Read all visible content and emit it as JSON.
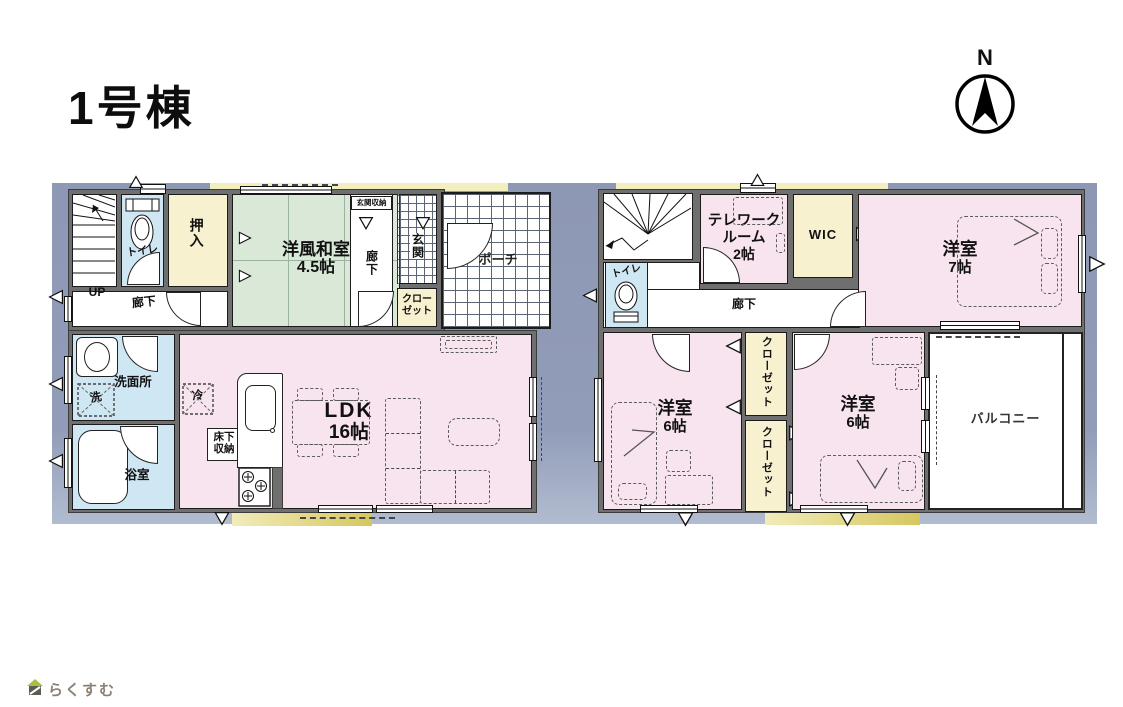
{
  "page": {
    "title": "1号棟"
  },
  "compass": {
    "label": "N"
  },
  "footer_logo": {
    "text": "らくすむ"
  },
  "colors": {
    "band": "#8d98b4",
    "wall": "#6f6f6f",
    "room_pink": "#f8e4ee",
    "tatami_green": "#d9e8d7",
    "closet_cream": "#f7f1d0",
    "wet_blue": "#cfe6f3",
    "eave_yellow": "#f3eebe",
    "eave_dark": "#d5c75f"
  },
  "floor1": {
    "up": "UP",
    "hall_front": "廊下",
    "toilet": "トイレ",
    "oshiire": "押入",
    "tatami_name": "洋風和室",
    "tatami_size": "4.5帖",
    "entry_storage": "玄関収納",
    "hall_entry": "廊下",
    "entry": "玄関",
    "closet_l1": "クロー",
    "closet_l2": "ゼット",
    "porch": "ポーチ",
    "washroom": "洗面所",
    "washer": "洗",
    "bath": "浴室",
    "ldk_name": "LDK",
    "ldk_size": "16帖",
    "fridge": "冷",
    "underfloor_l1": "床下",
    "underfloor_l2": "収納"
  },
  "floor2": {
    "down": "DN",
    "toilet": "トイレ",
    "telework_l1": "テレワーク",
    "telework_l2": "ルーム",
    "telework_l3": "2帖",
    "wic": "WIC",
    "bedroom7_name": "洋室",
    "bedroom7_size": "7帖",
    "hall": "廊下",
    "bedroom6a_name": "洋室",
    "bedroom6a_size": "6帖",
    "closet_a": "クローゼット",
    "closet_b": "クローゼット",
    "bedroom6b_name": "洋室",
    "bedroom6b_size": "6帖",
    "balcony": "バルコニー"
  }
}
